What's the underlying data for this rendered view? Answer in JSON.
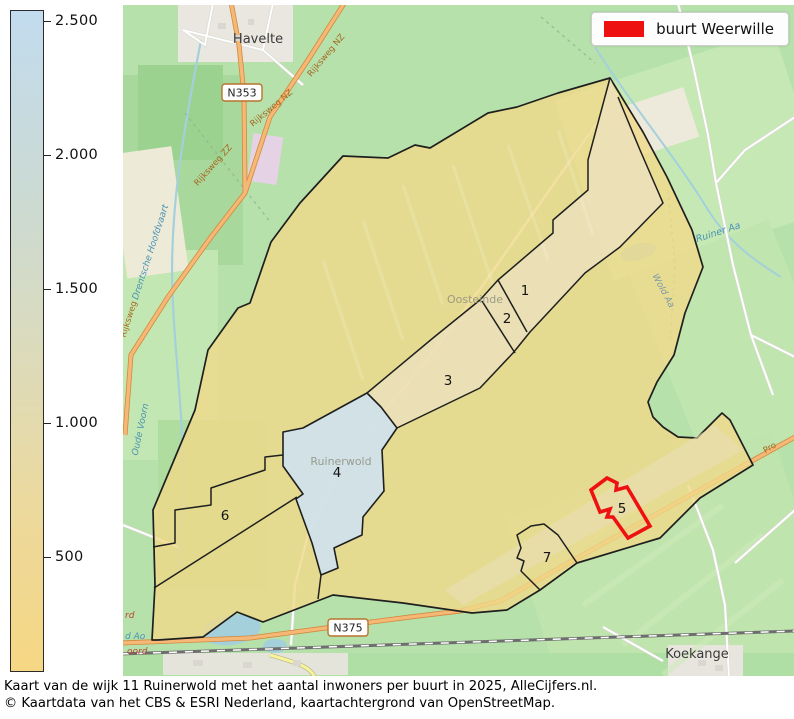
{
  "colorbar": {
    "ticks": [
      "2.500",
      "2.000",
      "1.500",
      "1.000",
      "500"
    ],
    "top_color": "#c2dbee",
    "bottom_color": "#f6d784"
  },
  "legend": {
    "label": "buurt Weerwille",
    "swatch_color": "#ee1111"
  },
  "regions": {
    "labels": [
      "1",
      "2",
      "3",
      "4",
      "5",
      "6",
      "7"
    ],
    "highlighted_number": "5",
    "highlight_name": "buurt Weerwille",
    "fill_yellow": "#f0d989",
    "fill_blue": "#cfe2ee",
    "outline_color": "#1f1f1f",
    "highlight_outline_color": "#ee1111"
  },
  "map": {
    "towns": [
      "Havelte",
      "Koekange"
    ],
    "places": [
      "Oosteinde",
      "Ruinerwold"
    ],
    "shields": [
      "N353",
      "N375"
    ],
    "roads": [
      "Rijksweg NZ",
      "Rijksweg NZ",
      "Rijksweg ZZ",
      "Rijksweg",
      "Pro"
    ],
    "waters": [
      "Drentsche Hoofdvaart",
      "Oude Voorn",
      "Ruiner Aa",
      "Wold Aa"
    ],
    "edge_labels": [
      "rd",
      "d Ao",
      "oord"
    ]
  },
  "caption": {
    "line1": "Kaart van de wijk 11 Ruinerwold met het aantal inwoners per buurt in 2025, AlleCijfers.nl.",
    "line2": "© Kaartdata van het CBS & ESRI Nederland, kaartachtergrond van OpenStreetMap."
  }
}
